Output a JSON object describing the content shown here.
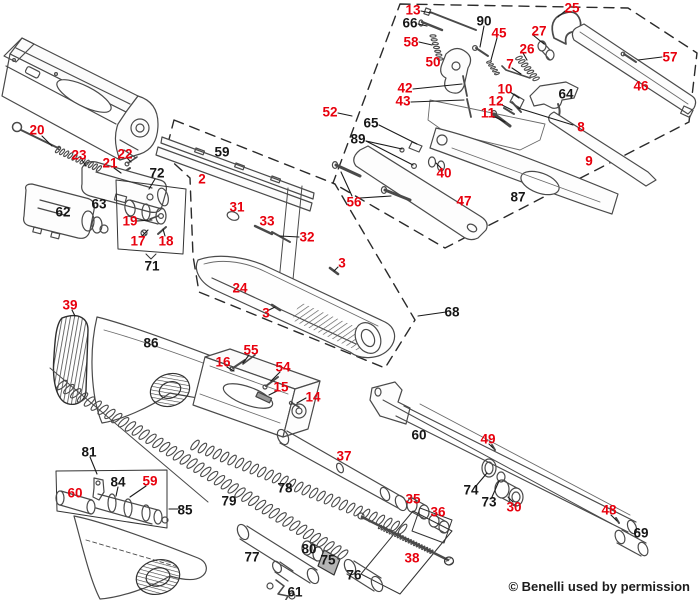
{
  "diagram": {
    "type": "exploded-parts-diagram",
    "subject": "Benelli semi-automatic shotgun schematic",
    "credit": "© Benelli used by permission",
    "label_colors": {
      "red": "#e8000d",
      "black": "#161616"
    },
    "labels": [
      {
        "n": "20",
        "c": "red",
        "x": 37,
        "y": 130
      },
      {
        "n": "23",
        "c": "red",
        "x": 79,
        "y": 155
      },
      {
        "n": "21",
        "c": "red",
        "x": 110,
        "y": 163
      },
      {
        "n": "22",
        "c": "red",
        "x": 125,
        "y": 154
      },
      {
        "n": "72",
        "c": "black",
        "x": 157,
        "y": 173
      },
      {
        "n": "59",
        "c": "black",
        "x": 222,
        "y": 152
      },
      {
        "n": "2",
        "c": "red",
        "x": 202,
        "y": 179
      },
      {
        "n": "62",
        "c": "black",
        "x": 63,
        "y": 212
      },
      {
        "n": "63",
        "c": "black",
        "x": 99,
        "y": 204
      },
      {
        "n": "19",
        "c": "red",
        "x": 130,
        "y": 221
      },
      {
        "n": "17",
        "c": "red",
        "x": 138,
        "y": 241
      },
      {
        "n": "18",
        "c": "red",
        "x": 166,
        "y": 241
      },
      {
        "n": "71",
        "c": "black",
        "x": 152,
        "y": 266
      },
      {
        "n": "39",
        "c": "red",
        "x": 70,
        "y": 305
      },
      {
        "n": "86",
        "c": "black",
        "x": 151,
        "y": 343
      },
      {
        "n": "31",
        "c": "red",
        "x": 237,
        "y": 207
      },
      {
        "n": "33",
        "c": "red",
        "x": 267,
        "y": 221
      },
      {
        "n": "32",
        "c": "red",
        "x": 307,
        "y": 237
      },
      {
        "n": "3",
        "c": "red",
        "x": 342,
        "y": 263
      },
      {
        "n": "24",
        "c": "red",
        "x": 240,
        "y": 288
      },
      {
        "n": "3",
        "c": "red",
        "x": 266,
        "y": 313
      },
      {
        "n": "68",
        "c": "black",
        "x": 452,
        "y": 312
      },
      {
        "n": "52",
        "c": "red",
        "x": 330,
        "y": 112
      },
      {
        "n": "13",
        "c": "red",
        "x": 413,
        "y": 10
      },
      {
        "n": "66",
        "c": "black",
        "x": 410,
        "y": 23
      },
      {
        "n": "58",
        "c": "red",
        "x": 411,
        "y": 42
      },
      {
        "n": "50",
        "c": "red",
        "x": 433,
        "y": 62
      },
      {
        "n": "90",
        "c": "black",
        "x": 484,
        "y": 21
      },
      {
        "n": "45",
        "c": "red",
        "x": 499,
        "y": 33
      },
      {
        "n": "27",
        "c": "red",
        "x": 539,
        "y": 31
      },
      {
        "n": "26",
        "c": "red",
        "x": 527,
        "y": 49
      },
      {
        "n": "25",
        "c": "red",
        "x": 572,
        "y": 8
      },
      {
        "n": "7",
        "c": "red",
        "x": 510,
        "y": 64
      },
      {
        "n": "57",
        "c": "red",
        "x": 670,
        "y": 57
      },
      {
        "n": "46",
        "c": "red",
        "x": 641,
        "y": 86
      },
      {
        "n": "42",
        "c": "red",
        "x": 405,
        "y": 88
      },
      {
        "n": "43",
        "c": "red",
        "x": 403,
        "y": 101
      },
      {
        "n": "64",
        "c": "black",
        "x": 566,
        "y": 94
      },
      {
        "n": "10",
        "c": "red",
        "x": 505,
        "y": 89
      },
      {
        "n": "12",
        "c": "red",
        "x": 496,
        "y": 101
      },
      {
        "n": "11",
        "c": "red",
        "x": 488,
        "y": 113
      },
      {
        "n": "8",
        "c": "red",
        "x": 581,
        "y": 127
      },
      {
        "n": "9",
        "c": "red",
        "x": 589,
        "y": 161
      },
      {
        "n": "65",
        "c": "black",
        "x": 371,
        "y": 123
      },
      {
        "n": "89",
        "c": "black",
        "x": 358,
        "y": 139
      },
      {
        "n": "40",
        "c": "red",
        "x": 444,
        "y": 173
      },
      {
        "n": "56",
        "c": "red",
        "x": 354,
        "y": 202
      },
      {
        "n": "47",
        "c": "red",
        "x": 464,
        "y": 201
      },
      {
        "n": "87",
        "c": "black",
        "x": 518,
        "y": 197
      },
      {
        "n": "16",
        "c": "red",
        "x": 223,
        "y": 362
      },
      {
        "n": "55",
        "c": "red",
        "x": 251,
        "y": 350
      },
      {
        "n": "54",
        "c": "red",
        "x": 283,
        "y": 367
      },
      {
        "n": "15",
        "c": "red",
        "x": 281,
        "y": 387
      },
      {
        "n": "14",
        "c": "red",
        "x": 313,
        "y": 397
      },
      {
        "n": "37",
        "c": "red",
        "x": 344,
        "y": 456
      },
      {
        "n": "60",
        "c": "black",
        "x": 419,
        "y": 435
      },
      {
        "n": "49",
        "c": "red",
        "x": 488,
        "y": 439
      },
      {
        "n": "74",
        "c": "black",
        "x": 471,
        "y": 490
      },
      {
        "n": "73",
        "c": "black",
        "x": 489,
        "y": 502
      },
      {
        "n": "30",
        "c": "red",
        "x": 514,
        "y": 507
      },
      {
        "n": "35",
        "c": "red",
        "x": 413,
        "y": 499
      },
      {
        "n": "36",
        "c": "red",
        "x": 438,
        "y": 512
      },
      {
        "n": "38",
        "c": "red",
        "x": 412,
        "y": 558
      },
      {
        "n": "48",
        "c": "red",
        "x": 609,
        "y": 510
      },
      {
        "n": "69",
        "c": "black",
        "x": 641,
        "y": 533
      },
      {
        "n": "78",
        "c": "black",
        "x": 285,
        "y": 488
      },
      {
        "n": "79",
        "c": "black",
        "x": 229,
        "y": 501
      },
      {
        "n": "81",
        "c": "black",
        "x": 89,
        "y": 452
      },
      {
        "n": "84",
        "c": "black",
        "x": 118,
        "y": 482
      },
      {
        "n": "59",
        "c": "red",
        "x": 150,
        "y": 481
      },
      {
        "n": "60",
        "c": "red",
        "x": 75,
        "y": 493
      },
      {
        "n": "85",
        "c": "black",
        "x": 185,
        "y": 510
      },
      {
        "n": "77",
        "c": "black",
        "x": 252,
        "y": 557
      },
      {
        "n": "80",
        "c": "black",
        "x": 309,
        "y": 549
      },
      {
        "n": "75",
        "c": "black",
        "x": 328,
        "y": 560
      },
      {
        "n": "76",
        "c": "black",
        "x": 354,
        "y": 575
      },
      {
        "n": "61",
        "c": "black",
        "x": 295,
        "y": 592
      }
    ]
  }
}
